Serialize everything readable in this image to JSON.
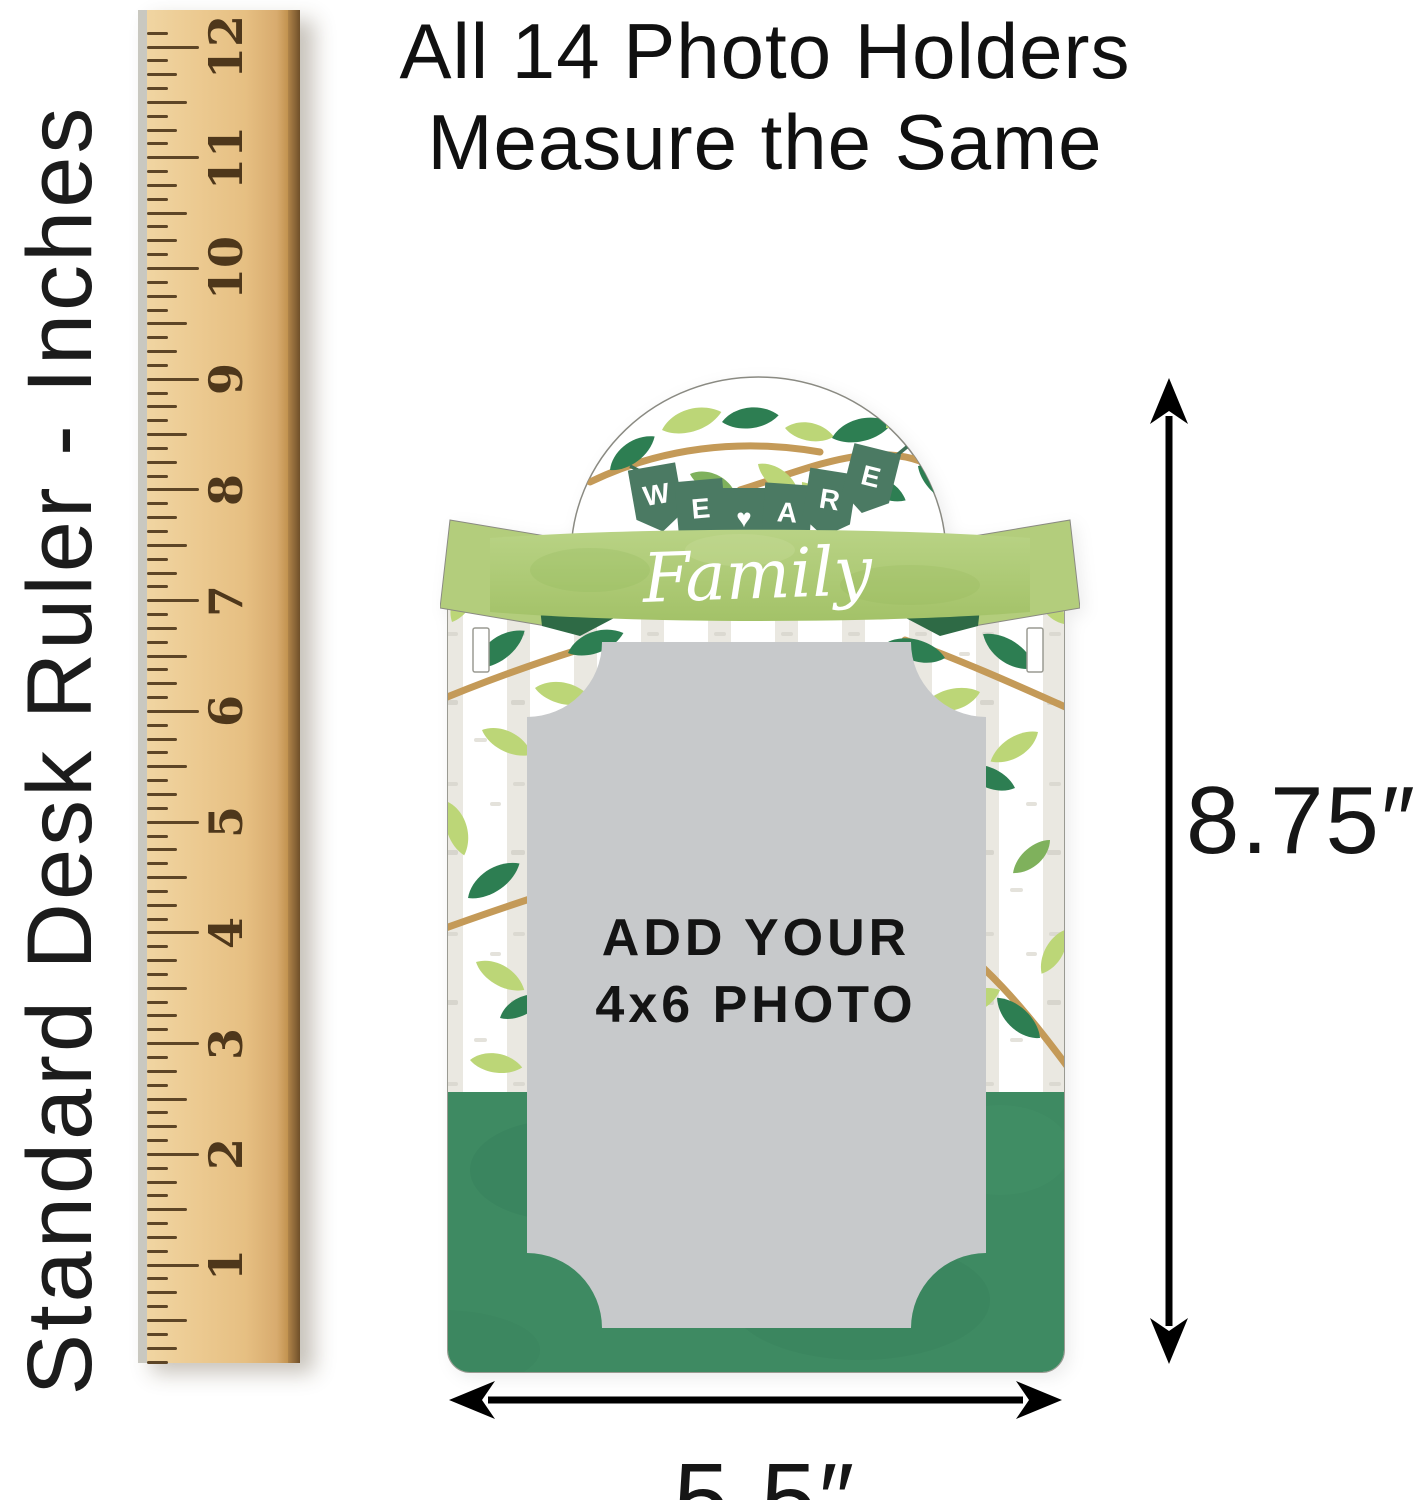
{
  "side_label": {
    "text": "Standard Desk Ruler - Inches"
  },
  "title": {
    "line1": "All 14 Photo Holders",
    "line2": "Measure the Same"
  },
  "ruler": {
    "unit": "inches",
    "numbers": [
      "12",
      "11",
      "10",
      "9",
      "8",
      "7",
      "6",
      "5",
      "4",
      "3",
      "2",
      "1"
    ],
    "wood_color": "#ecca91",
    "mark_color": "#5d4526"
  },
  "product": {
    "banner_letters": [
      "W",
      "E",
      "♥",
      "A",
      "R",
      "E"
    ],
    "ribbon_text": "Family",
    "photo_placeholder": {
      "line1": "ADD YOUR",
      "line2": "4x6 PHOTO"
    },
    "colors": {
      "pennant_green": "#4b7a63",
      "ribbon_green": "#aecb74",
      "fold_green": "#2e6a45",
      "base_green": "#3e8a62",
      "leaf_dark": "#2d7e52",
      "leaf_light": "#bcd677",
      "leaf_mid": "#7fb15c",
      "branch_tan": "#c49a58",
      "stripe_gray": "#eae8e1",
      "photo_gray": "#c7c9cb",
      "outline_gray": "#9a9a92"
    }
  },
  "dimensions": {
    "height_label": "8.75″",
    "width_label": "5.5″",
    "arrow_color": "#000000"
  }
}
